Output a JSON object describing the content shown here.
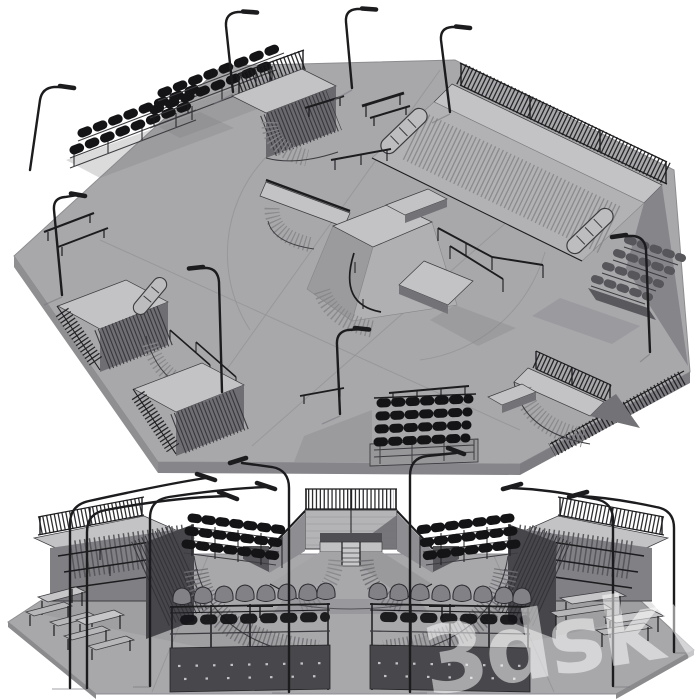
{
  "meta": {
    "description": "Grayscale 3D clay render of a modular skatepark model shown in two views: an isometric top view of the octagonal plaza and a front elevation view below it",
    "style": "monochrome clay render on white background"
  },
  "watermark": {
    "text": "3dsky"
  },
  "palette": {
    "bg": "#ffffff",
    "ground": "#a8a8ab",
    "ground_edge": "#8d8d90",
    "deck": "#c3c3c5",
    "mid": "#9b9b9e",
    "dark": "#737377",
    "deep": "#4b4b4f",
    "black": "#1c1c1f",
    "line": "#3c3c40",
    "seat": "#141417",
    "seat_gray": "#818186",
    "rib": "#86868a",
    "shadow": "#7e7e83",
    "seam": "#949497",
    "watermark": "rgba(255,255,255,0.52)"
  },
  "scene": {
    "top_view": {
      "label": "Isometric top view of octagonal skatepark plaza",
      "elements": [
        "bleacher seating with bucket seats",
        "corner grandstand",
        "quarter pipe with guard fence",
        "large bank ramp with stair capsules",
        "pyramid funbox with ledges and rails",
        "flat grind rails",
        "street benches",
        "curved street lamps",
        "perimeter picket fencing",
        "rear-view grandstand"
      ]
    },
    "front_view": {
      "label": "Front elevation view of the skatepark",
      "elements": [
        "left bank ramp with handrails",
        "right bank ramp with handrails",
        "central quarter pipe wall with guard fence",
        "pyramid funbox with center stairs",
        "banked corner transitions",
        "side grandstands",
        "foreground spectator seat rows",
        "picnic tables and benches",
        "curved street lamps"
      ]
    }
  }
}
